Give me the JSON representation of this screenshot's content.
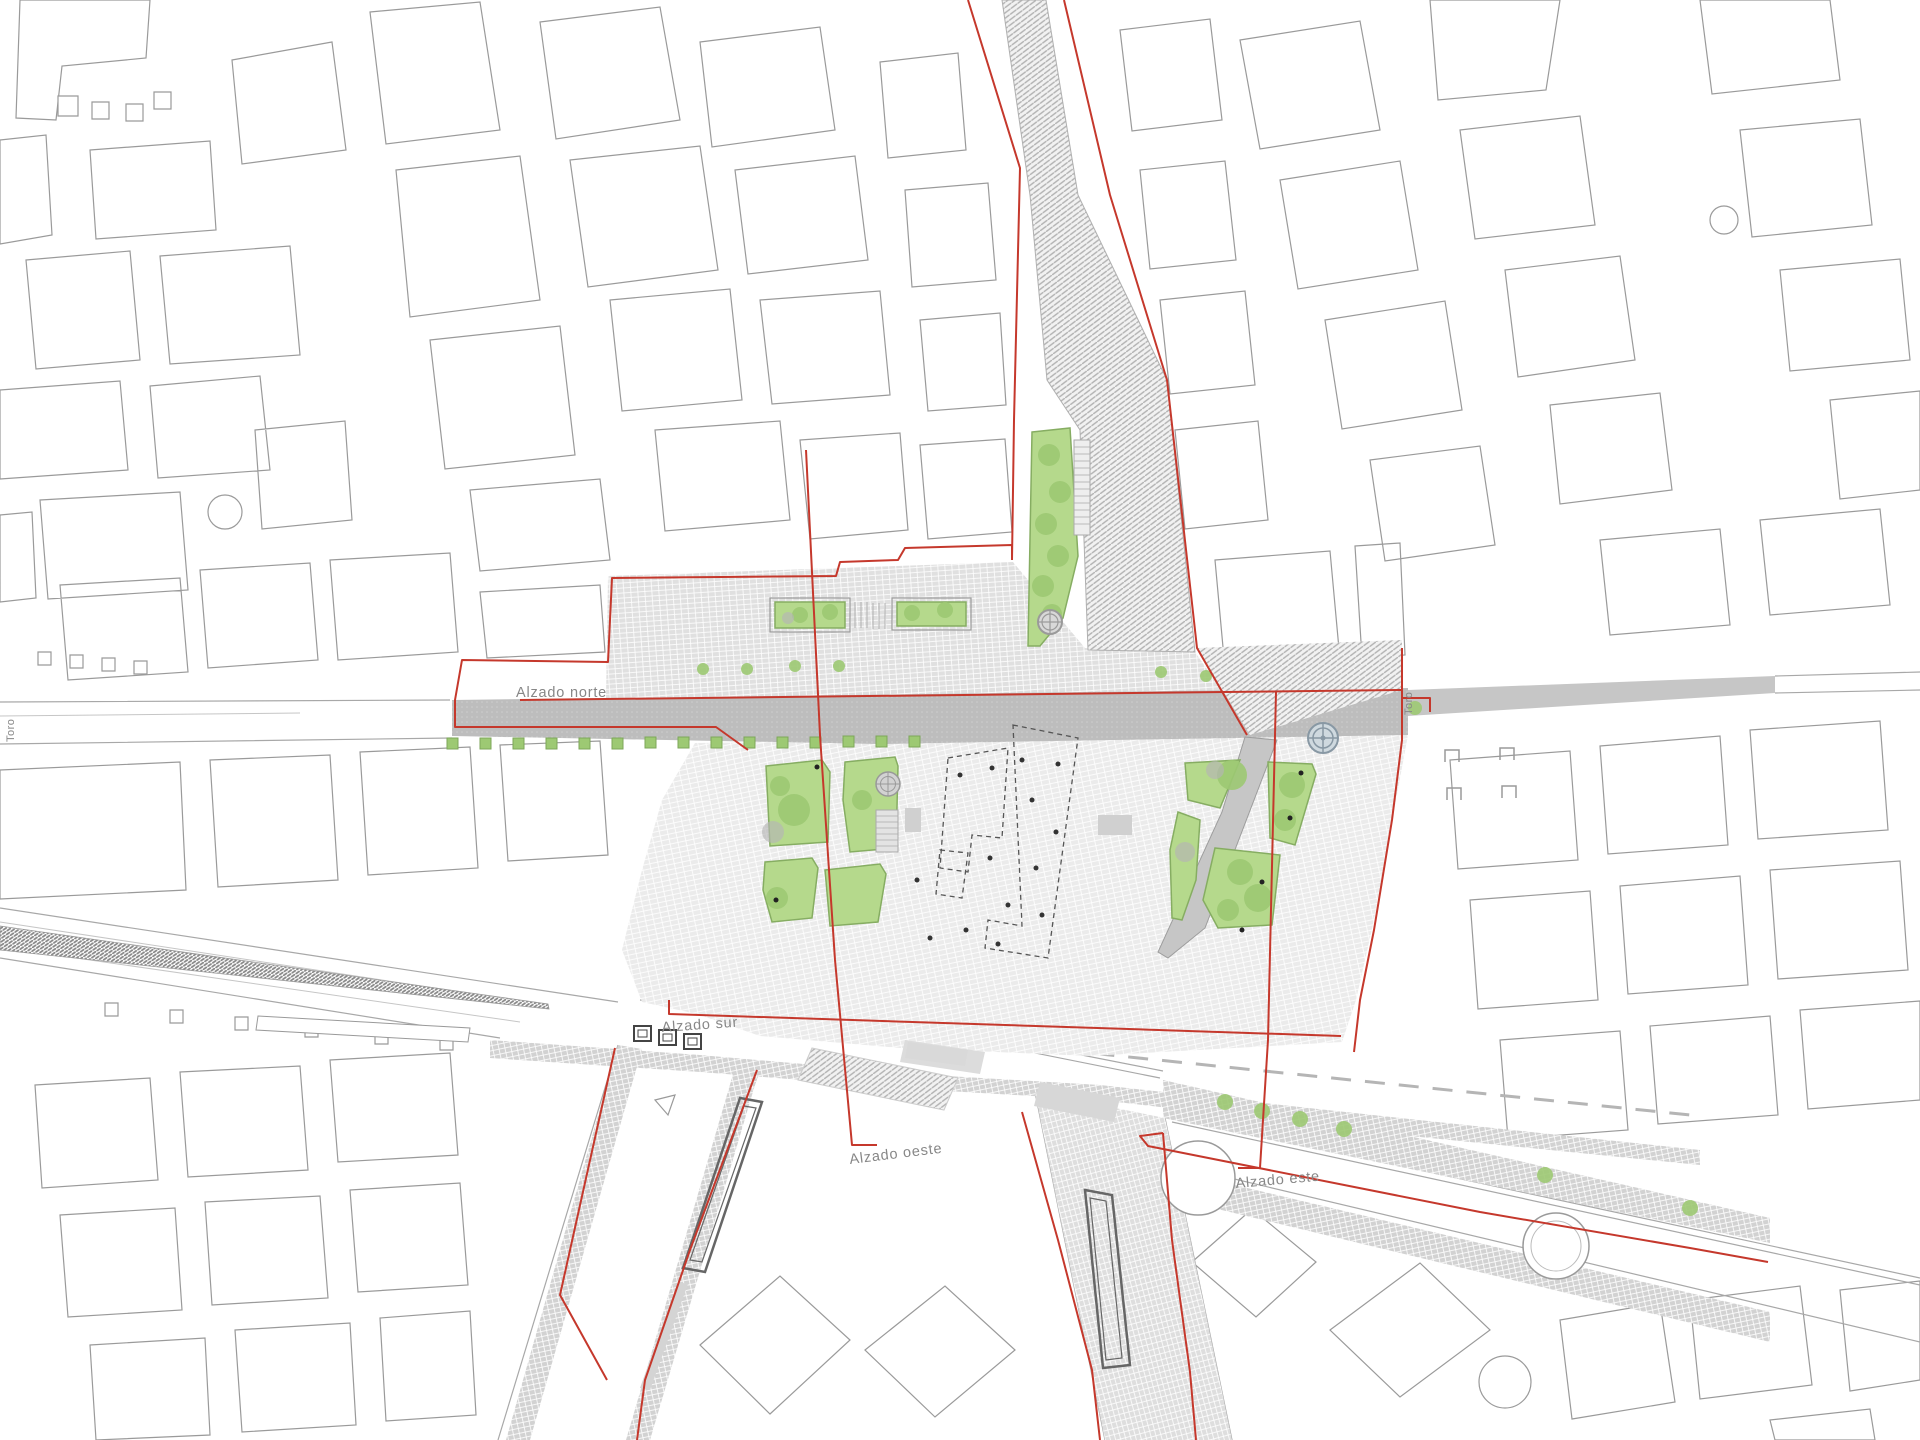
{
  "plan": {
    "section_labels": {
      "north": "Alzado norte",
      "south": "Alzado sur",
      "west": "Alzado oeste",
      "east": "Alzado este"
    },
    "street_labels": {
      "toro_west": "Toro",
      "toro_east": "Toro"
    },
    "colors": {
      "section_red": "#c5382c",
      "green_area": "#b5d98c",
      "tree_green": "#9dc973",
      "street_gray": "#bdbdbd",
      "paving_gray": "#ebebeb",
      "building_outline": "#9a9a9a",
      "label_gray": "#878787",
      "background": "#ffffff"
    }
  }
}
